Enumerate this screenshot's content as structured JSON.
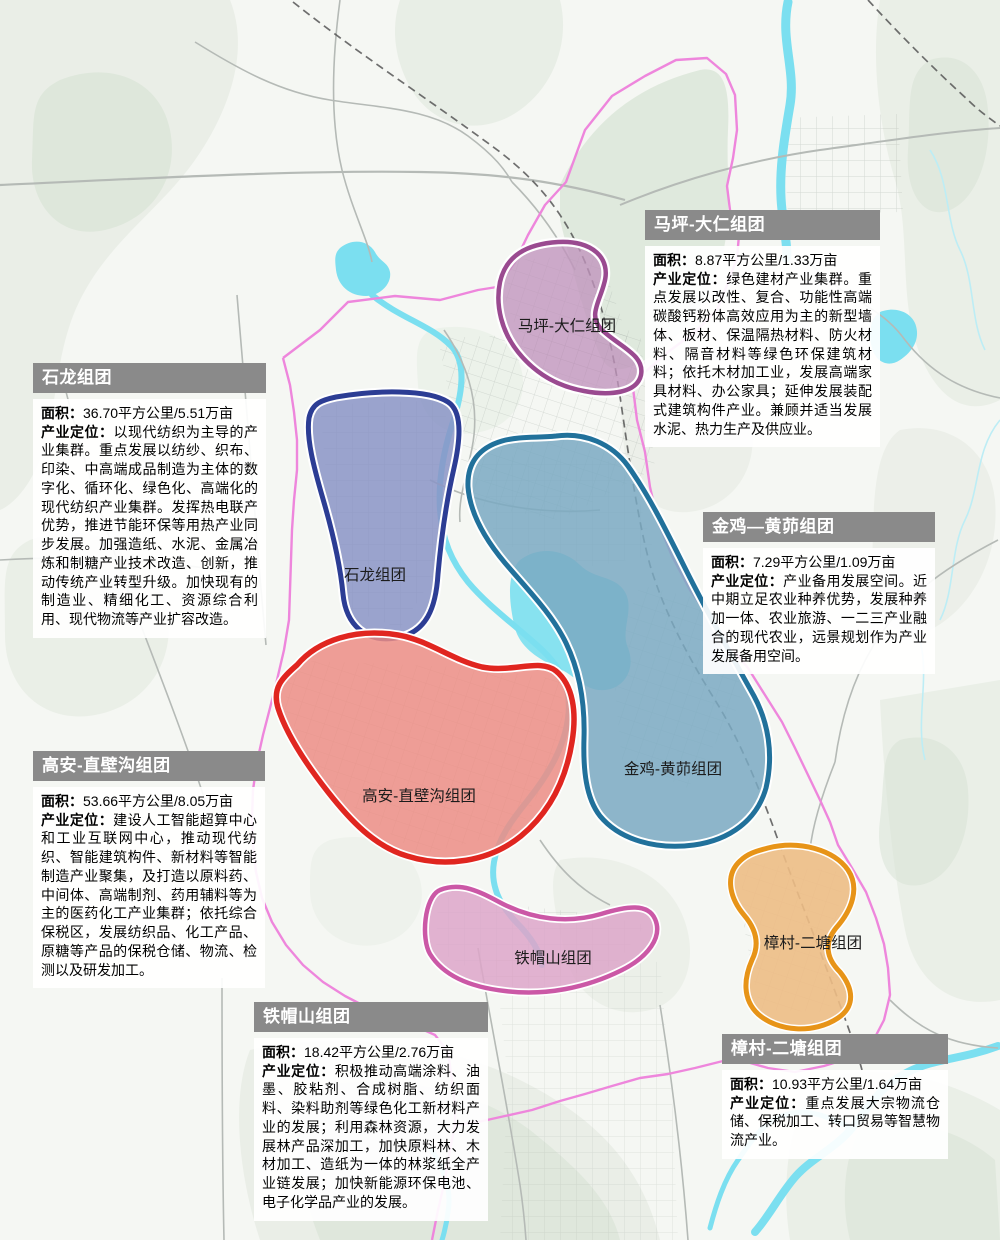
{
  "labels": {
    "area_label": "面积：",
    "positioning_label": "产业定位："
  },
  "map_colors": {
    "base": "#f5f7f3",
    "vegetation": "#e3eae0",
    "vegetation_dark": "#d6e2d3",
    "water": "#7bdff0",
    "stream": "#bdedf5",
    "road": "#b5bab6",
    "railway": "#565656",
    "boundary": "#ee86dc"
  },
  "clusters": [
    {
      "id": "maping-daren",
      "name": "马坪-大仁组团",
      "map_label": "马坪-大仁组团",
      "area": "8.87平方公里/1.33万亩",
      "positioning": "绿色建材产业集群。重点发展以改性、复合、功能性高端碳酸钙粉体高效应用为主的新型墙体、板材、保温隔热材料、防火材料、隔音材料等绿色环保建筑材料；依托木材加工业，发展高端家具材料、办公家具；延伸发展装配式建筑构件产业。兼顾并适当发展水泥、热力生产及供应业。",
      "stroke": "#9a4a90",
      "fill": "#c093bc"
    },
    {
      "id": "shilong",
      "name": "石龙组团",
      "map_label": "石龙组团",
      "area": "36.70平方公里/5.51万亩",
      "positioning": "以现代纺织为主导的产业集群。重点发展以纺纱、织布、印染、中高端成品制造为主体的数字化、循环化、绿色化、高端化的现代纺织产业集群。发挥热电联产优势，推进节能环保等用热产业同步发展。加强造纸、水泥、金属冶炼和制糖产业技术改造、创新，推动传统产业转型升级。加快现有的制造业、精细化工、资源综合利用、现代物流等产业扩容改造。",
      "stroke": "#2c3d94",
      "fill": "#8a94c6"
    },
    {
      "id": "jinji-huangmao",
      "name": "金鸡—黄茆组团",
      "map_label": "金鸡-黄茆组团",
      "area": "7.29平方公里/1.09万亩",
      "positioning": "产业备用发展空间。近中期立足农业种养优势，发展种养加一体、农业旅游、一二三产业融合的现代农业，远景规划作为产业发展备用空间。",
      "stroke": "#21719b",
      "fill": "#7aa9c2"
    },
    {
      "id": "gaoan-zhibigou",
      "name": "高安-直壁沟组团",
      "map_label": "高安-直壁沟组团",
      "area": "53.66平方公里/8.05万亩",
      "positioning": "建设人工智能超算中心和工业互联网中心，推动现代纺织、智能建筑构件、新材料等智能制造产业聚集，及打造以原料药、中间体、高端制剂、药用辅料等为主的医药化工产业集群；依托综合保税区，发展纺织品、化工产品、原糖等产品的保税仓储、物流、检测以及研发加工。",
      "stroke": "#e02620",
      "fill": "#ec8d85"
    },
    {
      "id": "tiemaoshan",
      "name": "铁帽山组团",
      "map_label": "铁帽山组团",
      "area": "18.42平方公里/2.76万亩",
      "positioning": "积极推动高端涂料、油墨、胶粘剂、合成树脂、纺织面料、染料助剂等绿色化工新材料产业的发展；利用森林资源，大力发展林产品深加工，加快原料林、木材加工、造纸为一体的林浆纸全产业链发展；加快新能源环保电池、电子化学品产业的发展。",
      "stroke": "#cb58a6",
      "fill": "#dda6c9"
    },
    {
      "id": "zhangcun-ertang",
      "name": "樟村-二塘组团",
      "map_label": "樟村-二塘组团",
      "area": "10.93平方公里/1.64万亩",
      "positioning": "重点发展大宗物流仓储、保税加工、转口贸易等智慧物流产业。",
      "stroke": "#e79418",
      "fill": "#edbd85"
    }
  ]
}
